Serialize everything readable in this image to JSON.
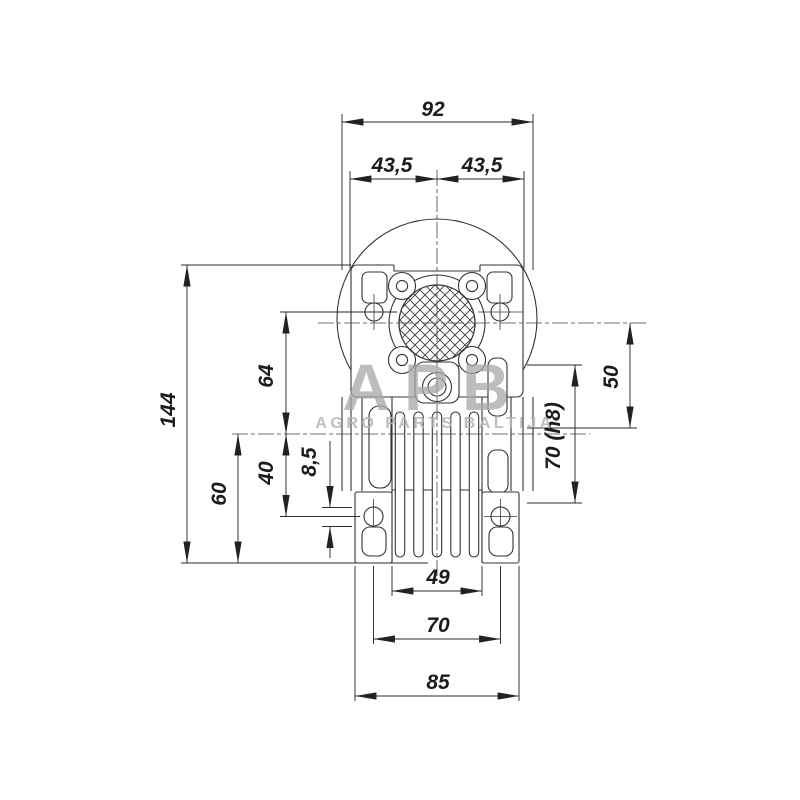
{
  "drawing": {
    "title": "gearbox-dimension-drawing"
  },
  "watermark": {
    "logo": "APB",
    "subtitle": "AGRO PARTS BALTIJA"
  },
  "dimensions": {
    "top": {
      "overall": "92",
      "left_half": "43,5",
      "right_half": "43,5"
    },
    "left": {
      "overall_height": "144",
      "base_to_axis": "60",
      "axis_to_flange_holes": "64",
      "axis_to_foot_holes": "40",
      "foot_hole_dia": "8,5"
    },
    "right": {
      "axis_to_bottom_ref": "50",
      "boss_dia": "70 (h8)"
    },
    "bottom": {
      "inner_width": "49",
      "foot_hole_spacing": "70",
      "overall_width": "85"
    }
  },
  "colors": {
    "line": "#333333",
    "dimension": "#2b2b2b",
    "text": "#1c1c1c",
    "watermark_logo": "#a8a8a8",
    "watermark_subtitle": "#b3b3b3",
    "background": "#ffffff"
  }
}
